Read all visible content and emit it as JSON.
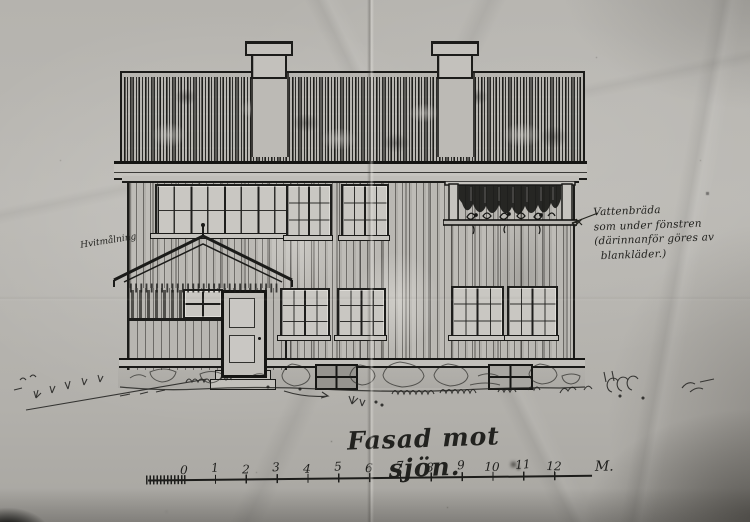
{
  "photo": {
    "medium": "black-and-white photograph of a hand-inked architectural elevation on creased paper",
    "paper_color": "#b7b5b0",
    "ink_color": "#1c1c1a"
  },
  "title": {
    "text": "Fasad mot sjön."
  },
  "scale_bar": {
    "labels": [
      "0",
      "1",
      "2",
      "3",
      "4",
      "5",
      "6",
      "7",
      "8",
      "9",
      "10",
      "11",
      "12"
    ],
    "unit": "M."
  },
  "notes": {
    "right": {
      "lines": [
        "Vattenbräda",
        "som under fönstren",
        "(därinnanför göres av",
        "blankläder.)"
      ]
    },
    "left": {
      "text": "Hvitmålning"
    }
  },
  "figure": {
    "subject": "two-storey timber house facade facing the lake",
    "chimneys": 2,
    "roof": "steep shingled roof drawn with dense vertical hatching",
    "porch": "gabled entrance porch with four-pane window, panelled door and stone steps",
    "balcony": "recessed opening at upper right with curtain valance and flower box on a board",
    "upper_windows": "window band of four sashes at left, two six-pane windows at centre",
    "lower_windows": "four six-pane windows",
    "foundation": "natural-stone plinth with two small cellar windows and grass tufts along the ground"
  }
}
